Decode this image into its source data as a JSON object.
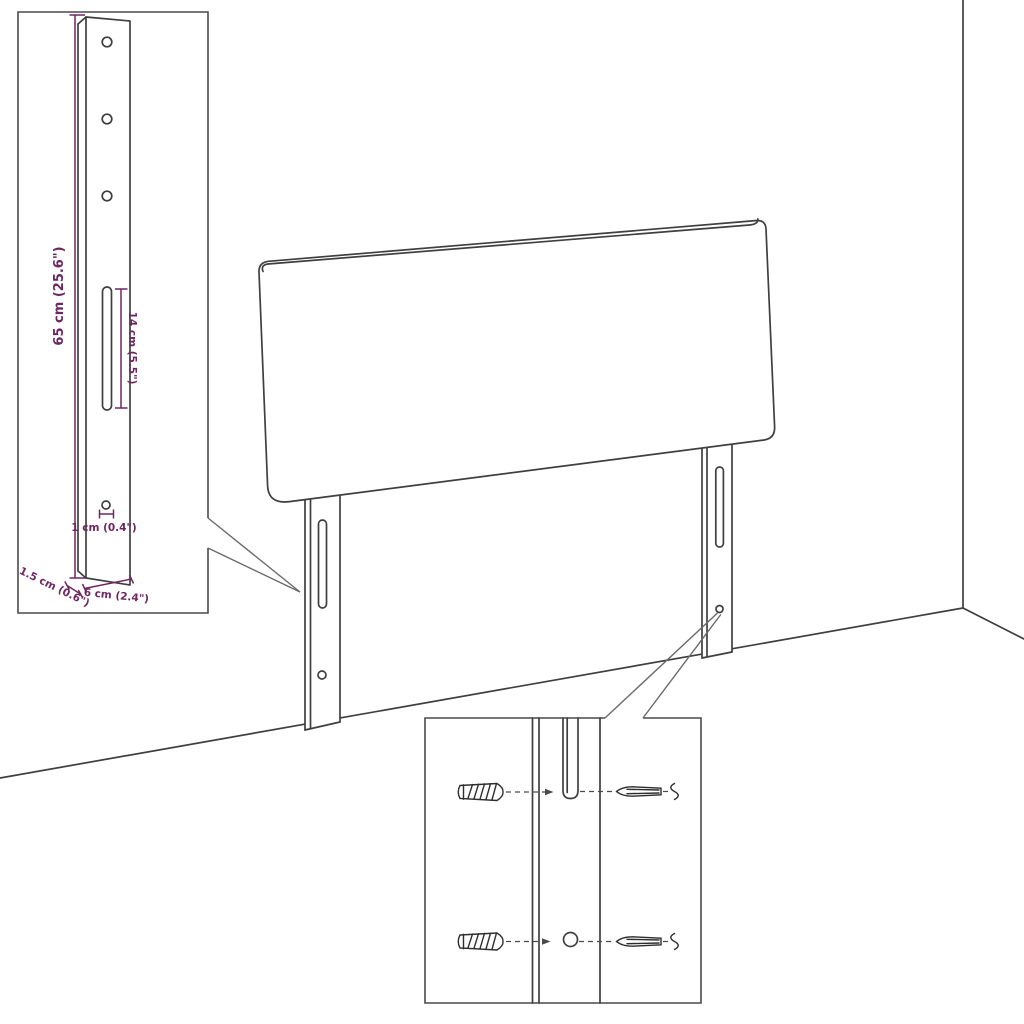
{
  "canvas": {
    "background": "#ffffff"
  },
  "colors": {
    "outline": "#3f3f3f",
    "inset_border": "#4a4a4a",
    "callout": "#6a6a6a",
    "dimension": "#6e2762"
  },
  "diagram": {
    "leg_detail_inset": {
      "dimensions": {
        "leg_height": "65 cm (25.6\")",
        "slot_length": "14 cm (5.5\")",
        "hole_size": "1 cm (0.4\")",
        "leg_thickness": "1.5 cm (0.6\")",
        "leg_width": "6 cm (2.4\")"
      }
    },
    "hardware_detail_inset": {
      "parts": [
        "wall-plug",
        "screw"
      ]
    }
  }
}
